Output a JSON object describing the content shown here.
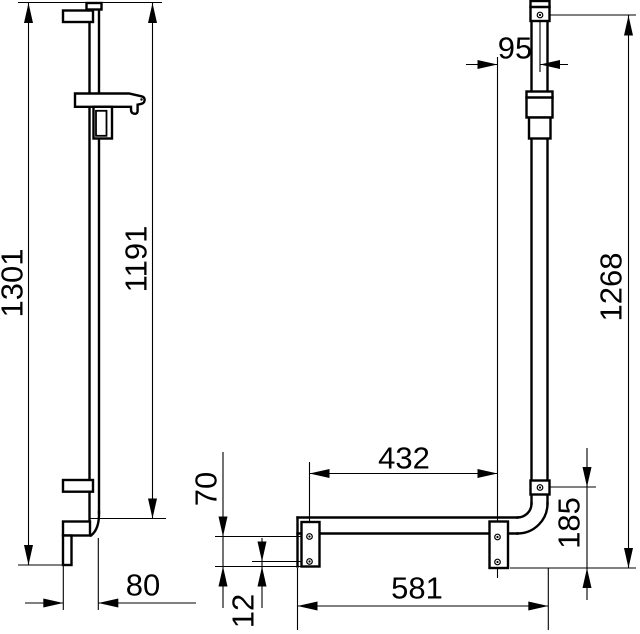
{
  "colors": {
    "line": "#000000",
    "bg": "#ffffff"
  },
  "dimensions": {
    "rail_total_height": {
      "label": "1301"
    },
    "rail_inner_height": {
      "label": "1191"
    },
    "top_plate_offset": {
      "label": "95"
    },
    "bar_vertical_height": {
      "label": "1268"
    },
    "plate_spacing": {
      "label": "432"
    },
    "plate_drop_height": {
      "label": "70"
    },
    "screw_edge_offset": {
      "label": "12"
    },
    "rail_wall_offset": {
      "label": "80"
    },
    "bar_horizontal_length": {
      "label": "581"
    },
    "corner_drop_height": {
      "label": "185"
    }
  }
}
